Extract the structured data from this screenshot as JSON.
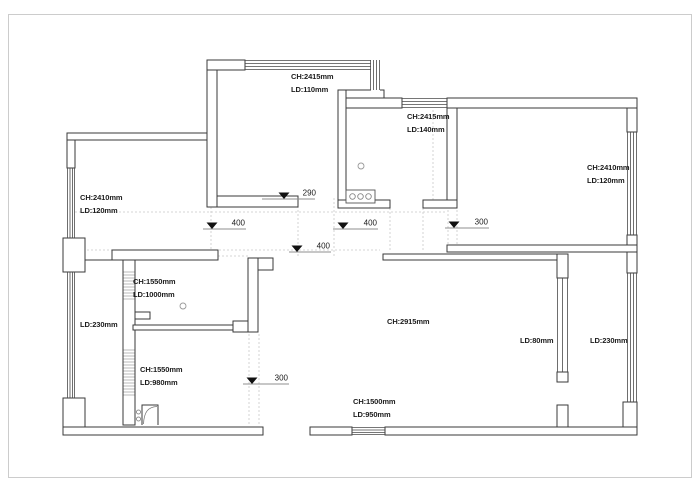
{
  "colors": {
    "background": "#ffffff",
    "wall": "#3a3a3a",
    "window_line": "#4a4a4a",
    "dashed_guide": "#c9c9c9",
    "page_border": "#cccccc",
    "marker_triangle": "#111111",
    "text": "#1c1c1c"
  },
  "plan": {
    "room_labels": [
      {
        "id": "north-balcony",
        "lines": [
          "CH:2415mm",
          "LD:110mm"
        ],
        "x": 291,
        "y": 70
      },
      {
        "id": "kitchen",
        "lines": [
          "CH:2415mm",
          "LD:140mm"
        ],
        "x": 407,
        "y": 110
      },
      {
        "id": "right-bedroom",
        "lines": [
          "CH:2410mm",
          "LD:120mm"
        ],
        "x": 587,
        "y": 161
      },
      {
        "id": "left-bedroom",
        "lines": [
          "CH:2410mm",
          "LD:120mm"
        ],
        "x": 80,
        "y": 191
      },
      {
        "id": "left-window",
        "lines": [
          "LD:230mm"
        ],
        "x": 80,
        "y": 318
      },
      {
        "id": "bath-upper",
        "lines": [
          "CH:1550mm",
          "LD:1000mm"
        ],
        "x": 133,
        "y": 275
      },
      {
        "id": "bath-lower",
        "lines": [
          "CH:1550mm",
          "LD:980mm"
        ],
        "x": 140,
        "y": 363
      },
      {
        "id": "living-room",
        "lines": [
          "CH:2915mm"
        ],
        "x": 387,
        "y": 315
      },
      {
        "id": "living-window",
        "lines": [
          "LD:80mm"
        ],
        "x": 520,
        "y": 334
      },
      {
        "id": "east-balcony-window",
        "lines": [
          "LD:230mm"
        ],
        "x": 590,
        "y": 334
      },
      {
        "id": "south-wall",
        "lines": [
          "CH:1500mm",
          "LD:950mm"
        ],
        "x": 353,
        "y": 395
      }
    ],
    "level_markers": [
      {
        "value": "290",
        "x1": 262,
        "len": 53,
        "y": 199,
        "tri": 284,
        "tx": 316
      },
      {
        "value": "400",
        "x1": 203,
        "len": 43,
        "y": 229,
        "tri": 212,
        "tx": 245
      },
      {
        "value": "400",
        "x1": 333,
        "len": 45,
        "y": 229,
        "tri": 343,
        "tx": 377
      },
      {
        "value": "300",
        "x1": 445,
        "len": 44,
        "y": 228,
        "tri": 454,
        "tx": 488
      },
      {
        "value": "400",
        "x1": 289,
        "len": 42,
        "y": 252,
        "tri": 297,
        "tx": 330
      },
      {
        "value": "300",
        "x1": 243,
        "len": 46,
        "y": 384,
        "tri": 252,
        "tx": 288
      }
    ],
    "icons": [
      "counter-with-burners-icon",
      "ceiling-lamp-icon",
      "door-swing-icon"
    ]
  }
}
